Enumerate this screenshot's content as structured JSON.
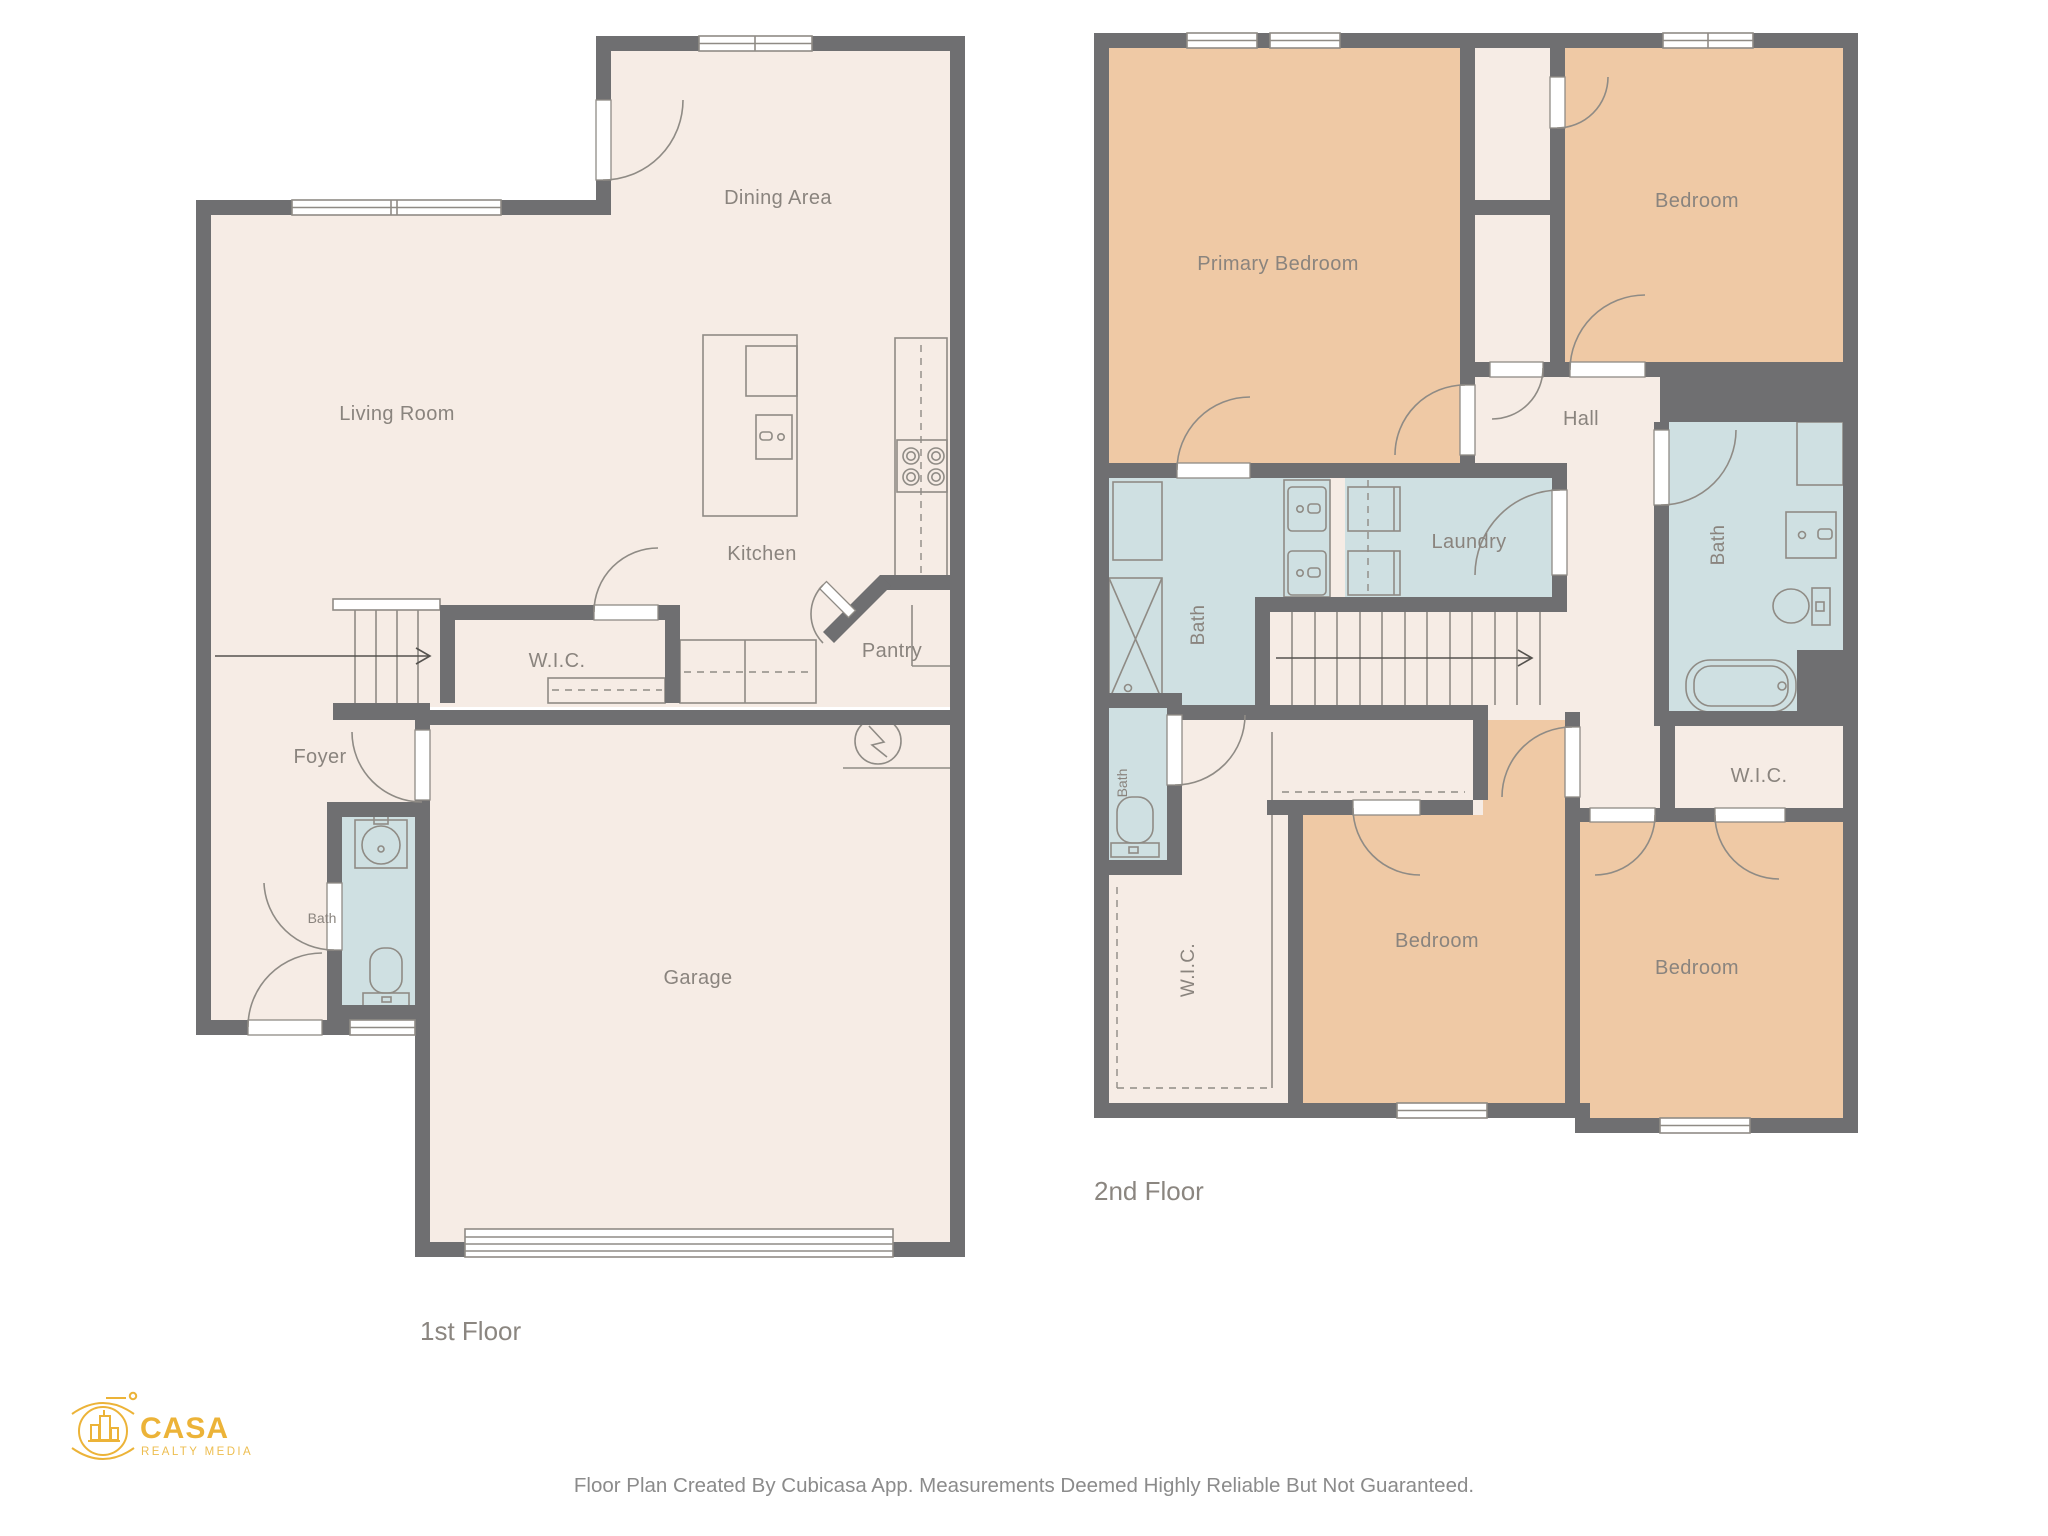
{
  "document": {
    "footer_disclaimer": "Floor Plan Created By Cubicasa App. Measurements Deemed Highly Reliable But Not Guaranteed."
  },
  "branding": {
    "name": "CASA",
    "tagline": "REALTY MEDIA",
    "color": "#ECB338"
  },
  "floor1": {
    "label": "1st Floor",
    "rooms": {
      "living_room": "Living Room",
      "dining_area": "Dining Area",
      "kitchen": "Kitchen",
      "wic": "W.I.C.",
      "pantry": "Pantry",
      "foyer": "Foyer",
      "bath": "Bath",
      "garage": "Garage"
    }
  },
  "floor2": {
    "label": "2nd Floor",
    "rooms": {
      "primary_bedroom": "Primary Bedroom",
      "bedroom_top_right": "Bedroom",
      "bedroom_bottom_middle": "Bedroom",
      "bedroom_bottom_right": "Bedroom",
      "hall": "Hall",
      "laundry": "Laundry",
      "bath_hall": "Bath",
      "bath_small": "Bath",
      "bath_right": "Bath",
      "wic_left": "W.I.C.",
      "wic_right": "W.I.C."
    }
  },
  "colors": {
    "wall": "#6F6F71",
    "floor": "#F6ECE5",
    "bedroom": "#EFC9A5",
    "wet_room": "#CFE0E2",
    "fixture_line": "#8F8B85",
    "label": "#8A847E",
    "brand_gold": "#ECB338"
  }
}
